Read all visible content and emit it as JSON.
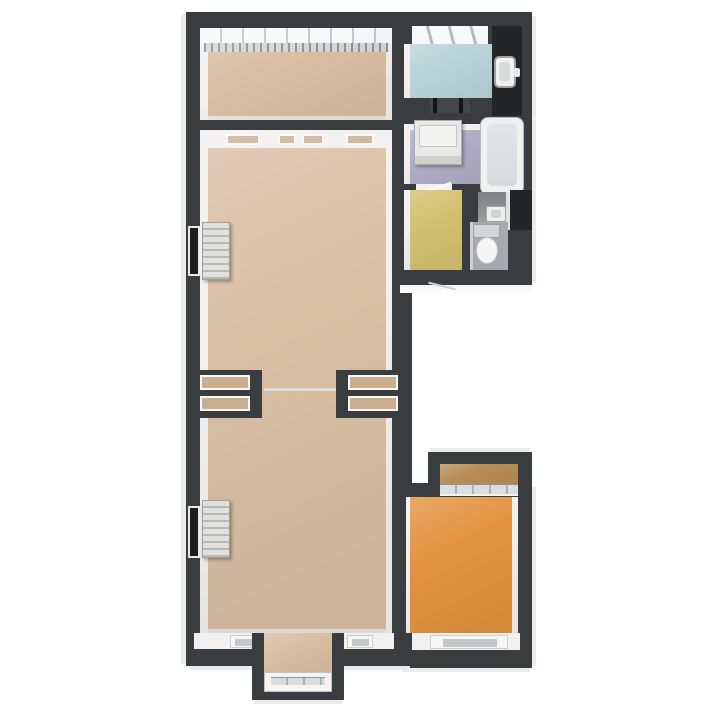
{
  "canvas": {
    "width": 720,
    "height": 720,
    "background": "#ffffff"
  },
  "palette": {
    "wall": "#3a3d3f",
    "shaft": "#232527",
    "inner_face": "#f1f0ee",
    "outer_face": "#ebebea",
    "glass": "#d9dde0",
    "fixture": "#efefed",
    "radiator_light": "#e0e0de",
    "radiator_dark": "#b9b9b7",
    "sill_recess": "#c5c8c9"
  },
  "walls": {
    "color": "#3a3d3f",
    "inner_face": "#f1f0ee",
    "shaft": "#232527"
  },
  "rooms": [
    {
      "id": "top-left-room",
      "floor_color": "#d9bea2",
      "fixtures": [
        "window-band",
        "radiator-strip"
      ]
    },
    {
      "id": "top-right-washroom",
      "floor_color": "#b9d3d8",
      "fixtures": [
        "skylight-window",
        "washbasin",
        "door-opening"
      ]
    },
    {
      "id": "laundry-bathroom",
      "floor_color": "#b0adc6",
      "fixtures": [
        "washing-machine",
        "bathtub"
      ]
    },
    {
      "id": "yellow-room",
      "floor_color": "#d3c071",
      "fixtures": [
        "door-opening"
      ]
    },
    {
      "id": "toilet-room",
      "floor_color": "#a8a9af",
      "fixtures": [
        "toilet",
        "small-washbasin",
        "duct-shaft"
      ]
    },
    {
      "id": "middle-room",
      "floor_color": "#d9bea2",
      "fixtures": [
        "transom-openings",
        "window",
        "radiator",
        "partition-openings"
      ]
    },
    {
      "id": "bottom-room",
      "floor_color": "#d9bea2",
      "fixtures": [
        "window",
        "radiator",
        "window-sills",
        "bay-window"
      ]
    },
    {
      "id": "balcony-strip",
      "floor_color": "#b68e58",
      "fixtures": [
        "window-band"
      ]
    },
    {
      "id": "orange-room",
      "floor_color": "#e2923e",
      "fixtures": [
        "window-sill"
      ]
    }
  ]
}
